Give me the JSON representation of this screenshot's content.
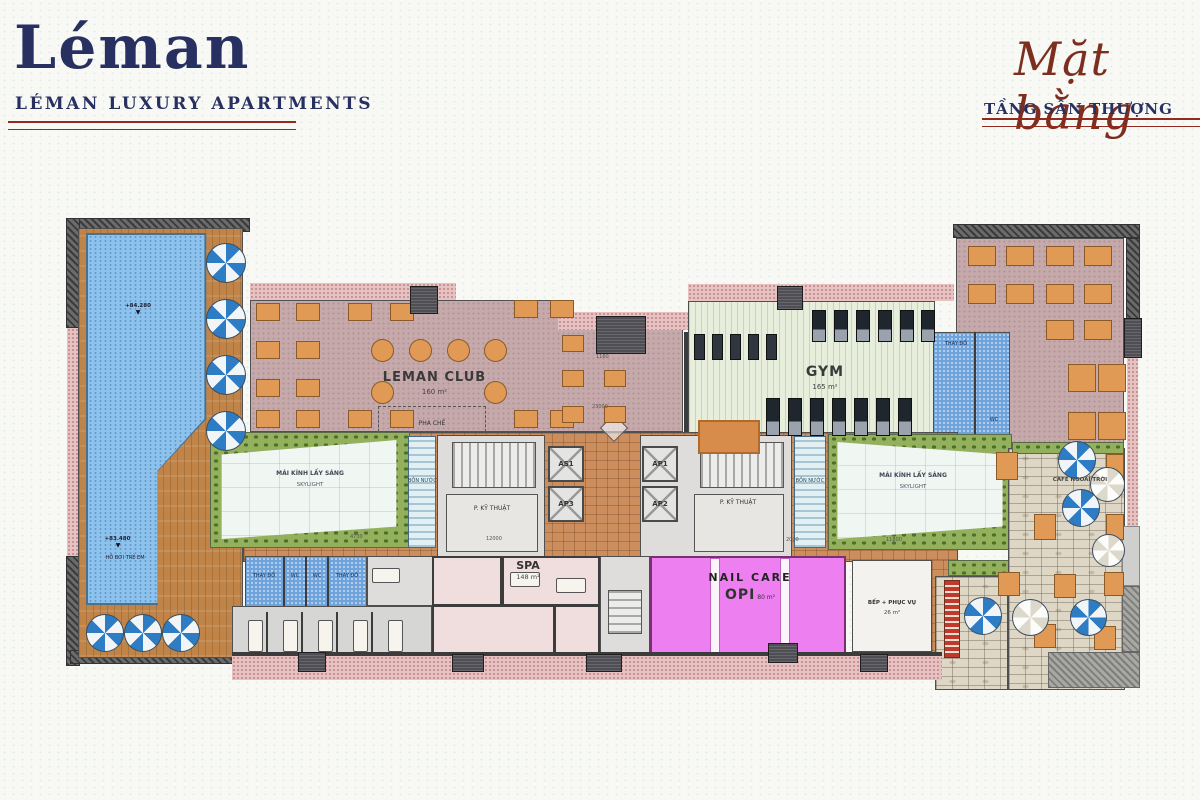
{
  "header": {
    "logo_text": "Léman",
    "logo_subtext": "LÉMAN LUXURY APARTMENTS",
    "plan_title_script": "Mặt bằng",
    "plan_title_caps": "TẦNG SÂN THƯỢNG"
  },
  "colors": {
    "brand_navy": "#283062",
    "brand_red": "#93291f",
    "pool_blue": "#8cc2ec",
    "club_mauve": "#c6a9ab",
    "gym_green": "#e7eedb",
    "nail_pink": "#ee7ff0",
    "deck_wood": "#c08448"
  },
  "rooms": {
    "leman_club": {
      "label": "LEMAN CLUB",
      "area": "160 m²"
    },
    "pha_che": {
      "label": "PHA CHẾ"
    },
    "gym": {
      "label": "GYM",
      "area": "165 m²"
    },
    "spa": {
      "label": "SPA",
      "area": "148 m²"
    },
    "nail_care": {
      "label": "NAIL CARE",
      "brand": "OPI",
      "area": "80 m²"
    },
    "kitchen": {
      "label": "BẾP + PHỤC VỤ",
      "area": "26 m²"
    },
    "skylight": {
      "label": "MÁI KÍNH LẤY SÁNG",
      "sublabel": "SKYLIGHT"
    },
    "tech_room": {
      "label": "P. KỸ THUẬT"
    },
    "water_tank": {
      "label": "BỒN NƯỚC"
    },
    "cafe": {
      "label": "CAFE NGOÀI TRỜI"
    },
    "pool": {
      "elevation_top": "+84.280",
      "elevation_low": "+83.480",
      "kids_label": "HỒ BƠI TRẺ EM",
      "level_marker": "▼"
    },
    "locker": {
      "cell1": "THAY ĐỒ",
      "cell2": "WC",
      "cell3": "WC",
      "cell4": "THAY ĐỒ"
    },
    "gym_locker": {
      "label1": "THAY ĐỒ",
      "label2": "WC"
    }
  },
  "elevators": {
    "as1": "AS1",
    "ap3": "AP3",
    "ap1": "AP1",
    "ap2": "AP2"
  },
  "dimensions": {
    "d1": "1160",
    "d2": "23000",
    "d3": "4730",
    "d4": "12000",
    "d5": "2000",
    "d6": "11800"
  }
}
